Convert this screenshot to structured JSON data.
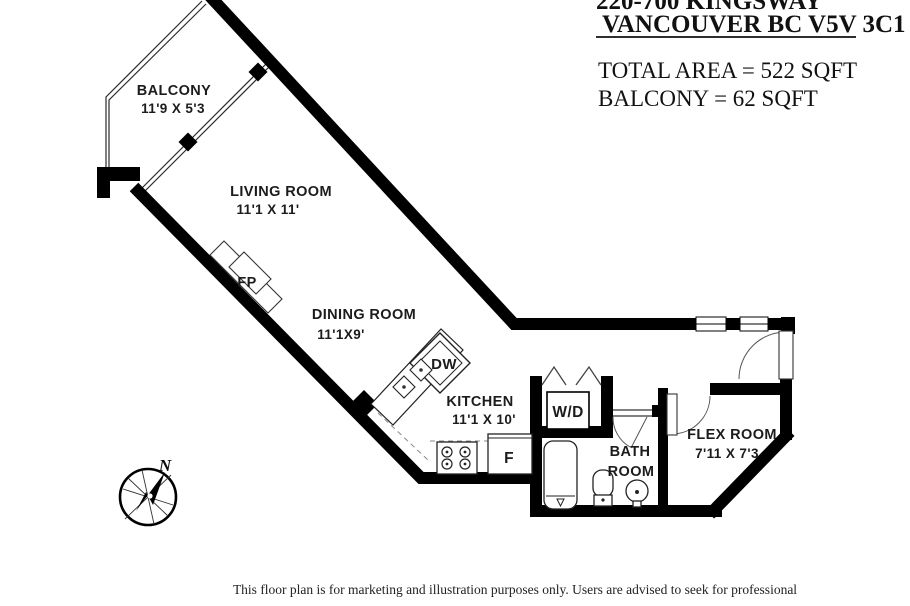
{
  "header": {
    "address_line1": "220-700 KINGSWAY",
    "address_line2": "VANCOUVER BC V5V 3C1",
    "total_area": "TOTAL AREA = 522 SQFT",
    "balcony_area": "BALCONY = 62 SQFT"
  },
  "plan": {
    "rooms": {
      "balcony": {
        "name": "BALCONY",
        "dims": "11'9 X 5'3"
      },
      "living": {
        "name": "LIVING ROOM",
        "dims": "11'1 X 11'"
      },
      "dining": {
        "name": "DINING ROOM",
        "dims": "11'1X9'"
      },
      "kitchen": {
        "name": "KITCHEN",
        "dims": "11'1 X 10'"
      },
      "bath": {
        "name_line1": "BATH",
        "name_line2": "ROOM"
      },
      "flex": {
        "name": "FLEX ROOM",
        "dims": "7'11 X 7'3"
      }
    },
    "fixtures": {
      "fireplace": "FP",
      "dishwasher": "DW",
      "washer_dryer": "W/D",
      "fridge": "F"
    },
    "compass_north": "N"
  },
  "footer": {
    "disclaimer": "This floor plan is for marketing and illustration purposes only. Users are advised to seek for professional"
  },
  "colors": {
    "wall": "#000000",
    "background": "#ffffff",
    "label": "#1c1c1c"
  }
}
